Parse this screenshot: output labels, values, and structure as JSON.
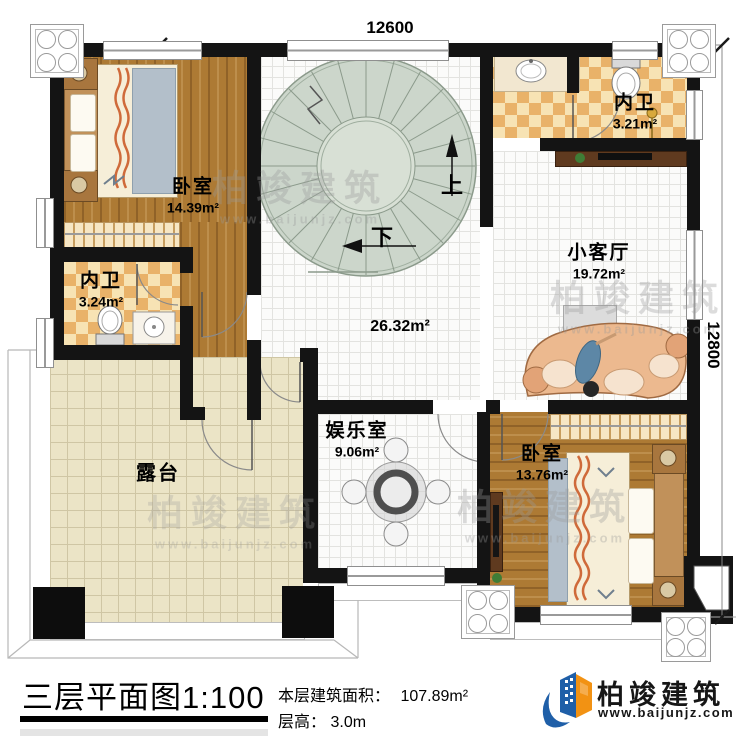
{
  "dims": {
    "width_label": "12600",
    "height_label": "12800"
  },
  "rooms": {
    "bedroom_tl": {
      "name": "卧室",
      "area": "14.39m²"
    },
    "bath_left": {
      "name": "内卫",
      "area": "3.24m²"
    },
    "bath_right": {
      "name": "内卫",
      "area": "3.21m²"
    },
    "living": {
      "name": "小客厅",
      "area": "19.72m²"
    },
    "hall": {
      "area": "26.32m²"
    },
    "recreation": {
      "name": "娱乐室",
      "area": "9.06m²"
    },
    "bedroom_br": {
      "name": "卧室",
      "area": "13.76m²"
    },
    "terrace": {
      "name": "露台"
    }
  },
  "stairs": {
    "up_label": "上",
    "down_label": "下"
  },
  "watermark": {
    "brand": "柏竣建筑",
    "url": "www.baijunjz.com"
  },
  "footer": {
    "title": "三层平面图1:100",
    "area_label": "本层建筑面积：",
    "area_value": "107.89m²",
    "height_label": "层高：",
    "height_value": "3.0m",
    "brand": "柏竣建筑",
    "brand_url": "www.baijunjz.com"
  },
  "colors": {
    "wall": "#141414",
    "wood": "#ad7a34",
    "checker_dark": "#e9b269",
    "checker_light": "#f7e3b4",
    "terrace": "#ebe4c6",
    "stair": "#ccd6cb",
    "sofa": "#ecb98f",
    "logo_blue": "#1f5fa8",
    "logo_orange": "#f29213"
  }
}
